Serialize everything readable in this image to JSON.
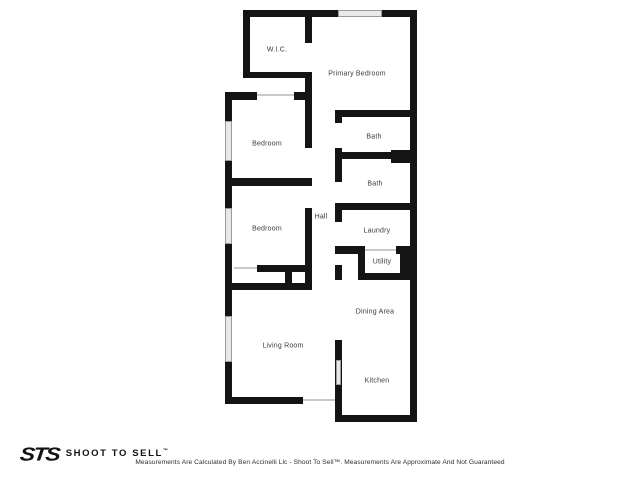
{
  "plan": {
    "rooms": {
      "wic": {
        "label": "W.I.C."
      },
      "primary_bedroom": {
        "label": "Primary Bedroom"
      },
      "bath1": {
        "label": "Bath"
      },
      "bedroom1": {
        "label": "Bedroom"
      },
      "bath2": {
        "label": "Bath"
      },
      "hall": {
        "label": "Hall"
      },
      "bedroom2": {
        "label": "Bedroom"
      },
      "laundry": {
        "label": "Laundry"
      },
      "utility": {
        "label": "Utility"
      },
      "dining": {
        "label": "Dining Area"
      },
      "living": {
        "label": "Living Room"
      },
      "kitchen": {
        "label": "Kitchen"
      }
    }
  },
  "footer": {
    "logo_sts": "STS",
    "logo_wordmark": "SHOOT TO SELL",
    "logo_tm": "™",
    "disclaimer": "Measurements Are Calculated By Ben Accinelli Llc - Shoot To Sell™. Measurements Are Approximate And Not Guaranteed"
  },
  "colors": {
    "wall": "#141414",
    "window_fill": "#e8e8e8",
    "window_border": "#9a9a9a",
    "door_line": "#c9c9c9",
    "label": "#3a3a3a",
    "background": "#ffffff"
  }
}
